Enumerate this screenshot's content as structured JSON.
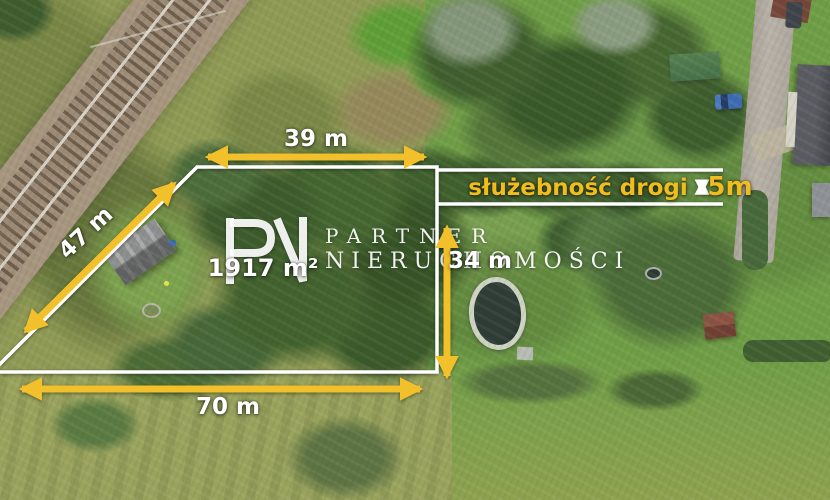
{
  "measurements": {
    "top_width": "39 m",
    "left_side": "47 m",
    "bottom_width": "70 m",
    "inner_depth": "34 m",
    "easement_width": "5m",
    "plot_area": "1917 m²"
  },
  "labels": {
    "easement": "służebność drogi"
  },
  "watermark": {
    "logo": "PN",
    "line1": "PARTNER",
    "line2": "NIERUCHOMOŚCI"
  },
  "colors": {
    "arrow_yellow": "#f1c02a",
    "easement_text_yellow": "#f0bd1c",
    "measurement_text": "#ffffff",
    "boundary_line": "#ffffff"
  }
}
